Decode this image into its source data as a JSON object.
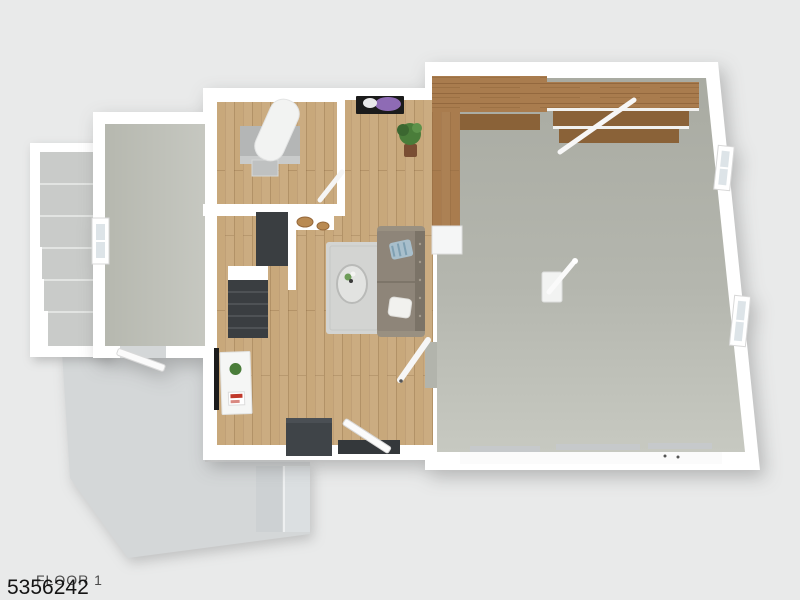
{
  "footer": {
    "floor_label": "FLOOR 1",
    "listing_id": "5356242"
  },
  "colors": {
    "background": "#e9eaea",
    "wall": "#ffffff",
    "basement_floor": "#b6b8af",
    "wood_floor": "#c8a87b",
    "garage_floor": "#b2b4ac",
    "patio": "#d4d7d8",
    "patio_step_light": "#dbdfe1",
    "patio_step_dark": "#cdd1d3",
    "exterior_step": "#c9cbc9",
    "stairs_dark": "#3a3e41",
    "stairs_step_edge": "#55595c",
    "counter": "#b4b6b6",
    "water_heater": "#f2f3f2",
    "wood_shelf": "#a97c4e",
    "wood_shelf_dark": "#8a6238",
    "sofa": "#8e8579",
    "sofa_back": "#7b7367",
    "sofa_arm": "#999081",
    "rug": "#d3d4d2",
    "ottoman": "#3f4448",
    "threshold": "#34383b",
    "tv_black": "#1b1b1b",
    "desk_white": "#f5f6f5",
    "plant_green": "#4a7d3a",
    "pot_brown": "#7a4e33",
    "flower_purple": "#8e6bb5",
    "basket_tan": "#b98a52",
    "pillow_blue": "#a8bfcc",
    "pillow_white": "#f1f1ee",
    "window_glass": "#dde4e8",
    "text_gray": "#4c4c4c",
    "text_dark": "#141414"
  }
}
